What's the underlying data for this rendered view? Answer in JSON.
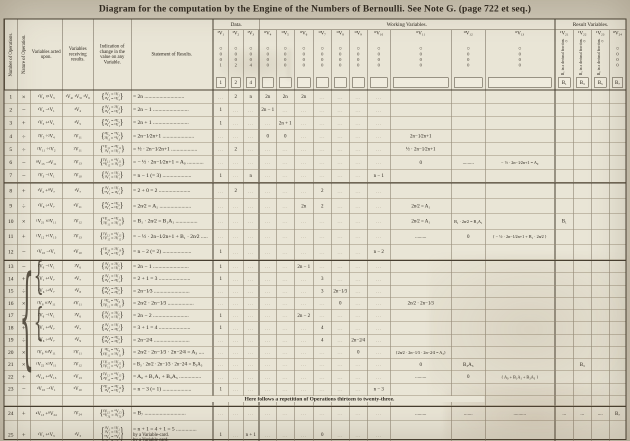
{
  "title": "Diagram for the computation by the Engine of the Numbers of Bernoulli.   See Note G. (page 722 et seq.)",
  "header": {
    "left_columns": [
      "Number of Operations.",
      "Nature of Operation.",
      "Variables acted upon.",
      "Variables receiving results.",
      "Indication of change in the value on any Variable.",
      "Statement of Results."
    ],
    "groups": {
      "data": "Data.",
      "working": "Working Variables.",
      "results": "Result Variables."
    },
    "variables": [
      {
        "id": "v1",
        "label": "¹V₁",
        "dial": [
          "0",
          "0",
          "1"
        ],
        "box": "1"
      },
      {
        "id": "v2",
        "label": "¹V₂",
        "dial": [
          "0",
          "0",
          "2"
        ],
        "box": "2"
      },
      {
        "id": "v3",
        "label": "¹V₃",
        "dial": [
          "0",
          "0",
          "4"
        ],
        "box": "4"
      },
      {
        "id": "v4",
        "label": "⁰V₄",
        "dial": [
          "0",
          "0",
          "0"
        ],
        "box": ""
      },
      {
        "id": "v5",
        "label": "⁰V₅",
        "dial": [
          "0",
          "0",
          "0"
        ],
        "box": ""
      },
      {
        "id": "v6",
        "label": "⁰V₆",
        "dial": [
          "0",
          "0",
          "0"
        ],
        "box": ""
      },
      {
        "id": "v7",
        "label": "⁰V₇",
        "dial": [
          "0",
          "0",
          "0"
        ],
        "box": ""
      },
      {
        "id": "v8",
        "label": "⁰V₈",
        "dial": [
          "0",
          "0",
          "0"
        ],
        "box": ""
      },
      {
        "id": "v9",
        "label": "⁰V₉",
        "dial": [
          "0",
          "0",
          "0"
        ],
        "box": ""
      },
      {
        "id": "v10",
        "label": "⁰V₁₀",
        "dial": [
          "0",
          "0",
          "0"
        ],
        "box": ""
      },
      {
        "id": "v11",
        "label": "⁰V₁₁",
        "dial": [
          "0",
          "0",
          "0"
        ],
        "box": ""
      },
      {
        "id": "v12",
        "label": "⁰V₁₂",
        "dial": [
          "0",
          "0",
          "0"
        ],
        "box": ""
      },
      {
        "id": "v13",
        "label": "⁰V₁₃",
        "dial": [
          "0",
          "0",
          "0"
        ],
        "box": ""
      },
      {
        "id": "v21",
        "label": "¹V₂₁",
        "rot": "B₁ in a decimal fraction.",
        "box": "B₁"
      },
      {
        "id": "v22",
        "label": "¹V₂₂",
        "rot": "B₃ in a decimal fraction.",
        "box": "B₃"
      },
      {
        "id": "v23",
        "label": "¹V₂₃",
        "rot": "B₅ in a decimal fraction.",
        "box": "B₅"
      },
      {
        "id": "v24",
        "label": "⁰V₂₄",
        "dial": [
          "0",
          "0",
          "0"
        ],
        "box": "B₇"
      }
    ]
  },
  "repetition_note": "Here follows a repetition of Operations thirteen to twenty-three.",
  "cell_filler": "...",
  "rows": [
    {
      "num": "1",
      "op": "×",
      "acted": "¹V₂ ×¹V₃",
      "recv": "¹V₄, ¹V₅, ¹V₆",
      "ind": [
        "¹V₂ = ¹V₂",
        "¹V₃ = ¹V₃"
      ],
      "stmt": "= 2n .............................",
      "cells": {
        "v2": "2",
        "v3": "n",
        "v4": "2n",
        "v5": "2n",
        "v6": "2n"
      }
    },
    {
      "num": "2",
      "op": "−",
      "acted": "¹V₄ −¹V₁",
      "recv": "²V₄",
      "ind": [
        "¹V₄ = ²V₄",
        "¹V₁ = ¹V₁"
      ],
      "stmt": "= 2n − 1 ..........................",
      "cells": {
        "v1": "1",
        "v4": "2n − 1"
      }
    },
    {
      "num": "3",
      "op": "+",
      "acted": "¹V₅ +¹V₁",
      "recv": "²V₅",
      "ind": [
        "¹V₅ = ²V₅",
        "¹V₁ = ¹V₁"
      ],
      "stmt": "= 2n + 1 ..........................",
      "cells": {
        "v1": "1",
        "v5": "2n + 1"
      }
    },
    {
      "num": "4",
      "op": "÷",
      "acted": "²V₅ ÷²V₄",
      "recv": "¹V₁₁",
      "ind": [
        "²V₅ = ⁰V₅",
        "²V₄ = ⁰V₄"
      ],
      "stmt": "= 2n−1⁄2n+1 .......................",
      "cells": {
        "v4": "0",
        "v5": "0",
        "v11": "2n−1⁄2n+1"
      }
    },
    {
      "num": "5",
      "op": "÷",
      "acted": "¹V₁₁ ÷¹V₂",
      "recv": "²V₁₁",
      "ind": [
        "¹V₁₁ = ²V₁₁",
        "¹V₂ = ¹V₂"
      ],
      "stmt": "= ½ · 2n−1⁄2n+1 ...................",
      "cells": {
        "v2": "2",
        "v11": "½ · 2n−1⁄2n+1"
      }
    },
    {
      "num": "6",
      "op": "−",
      "acted": "⁰V₁₃ −²V₁₁",
      "recv": "¹V₁₃",
      "ind": [
        "²V₁₁ = ⁰V₁₁",
        "⁰V₁₃ = ¹V₁₃"
      ],
      "stmt": "= − ½ · 2n−1⁄2n+1 = A₀ ............",
      "cells": {
        "v11": "0",
        "v12": ".........",
        "v13": "− ½ · 2n−1⁄2n+1 = A₀"
      }
    },
    {
      "num": "7",
      "op": "−",
      "acted": "¹V₃ −¹V₁",
      "recv": "¹V₁₀",
      "ind": [
        "¹V₃ = ¹V₃",
        "¹V₁ = ¹V₁"
      ],
      "stmt": "= n − 1 (= 3) .....................",
      "cells": {
        "v1": "1",
        "v3": "n",
        "v10": "n − 1"
      }
    },
    {
      "num": "8",
      "op": "+",
      "acted": "¹V₂ +⁰V₇",
      "recv": "¹V₇",
      "ind": [
        "¹V₂ = ¹V₂",
        "⁰V₇ = ¹V₇"
      ],
      "stmt": "= 2 + 0 = 2 .......................",
      "cells": {
        "v2": "2",
        "v7": "2"
      }
    },
    {
      "num": "9",
      "op": "÷",
      "acted": "¹V₆ ÷¹V₇",
      "recv": "³V₁₁",
      "ind": [
        "¹V₆ = ¹V₆",
        "¹V₇ = ¹V₇"
      ],
      "stmt": "= 2n⁄2 = A₁ .......................",
      "cells": {
        "v6": "2n",
        "v7": "2",
        "v11": "2n⁄2 = A₁"
      }
    },
    {
      "num": "10",
      "op": "×",
      "acted": "¹V₂₁ ×³V₁₁",
      "recv": "¹V₁₂",
      "ind": [
        "¹V₂₁ = ¹V₂₁",
        "³V₁₁ = ³V₁₁"
      ],
      "stmt": "= B₁ · 2n⁄2 = B₁A₁ ................",
      "cells": {
        "v11": "2n⁄2 = A₁",
        "v12": "B₁ · 2n⁄2 = B₁A₁",
        "v21": "B₁"
      }
    },
    {
      "num": "11",
      "op": "+",
      "acted": "¹V₁₂ +¹V₁₃",
      "recv": "²V₁₃",
      "ind": [
        "¹V₁₂ = ⁰V₁₂",
        "¹V₁₃ = ²V₁₃"
      ],
      "stmt": "= − ½ · 2n−1⁄2n+1 + B₁ · 2n⁄2 .....",
      "cells": {
        "v11": ".........",
        "v12": "0",
        "v13": "{ − ½ · 2n−1⁄2n+1 + B₁ · 2n⁄2 }"
      }
    },
    {
      "num": "12",
      "op": "−",
      "acted": "¹V₁₀ −¹V₁",
      "recv": "²V₁₀",
      "ind": [
        "¹V₁₀ = ²V₁₀",
        "¹V₁ = ¹V₁"
      ],
      "stmt": "= n − 2 (= 2) .....................",
      "cells": {
        "v1": "1",
        "v10": "n − 2"
      }
    },
    {
      "num": "13",
      "op": "−",
      "acted": "¹V₆ −¹V₁",
      "recv": "²V₆",
      "ind": [
        "¹V₆ = ²V₆",
        "¹V₁ = ¹V₁"
      ],
      "stmt": "= 2n − 1 ..........................",
      "cells": {
        "v1": "1",
        "v6": "2n − 1"
      }
    },
    {
      "num": "14",
      "op": "+",
      "acted": "¹V₁ +¹V₇",
      "recv": "²V₇",
      "ind": [
        "¹V₁ = ¹V₁",
        "¹V₇ = ²V₇"
      ],
      "stmt": "= 2 + 1 = 3 .......................",
      "cells": {
        "v1": "1",
        "v7": "3"
      }
    },
    {
      "num": "15",
      "op": "÷",
      "acted": "²V₆ ÷²V₇",
      "recv": "¹V₈",
      "ind": [
        "²V₆ = ²V₆",
        "²V₇ = ²V₇"
      ],
      "stmt": "= 2n−1⁄3 ..........................",
      "cells": {
        "v7": "3",
        "v8": "2n−1⁄3"
      }
    },
    {
      "num": "16",
      "op": "×",
      "acted": "¹V₈ ×³V₁₁",
      "recv": "⁴V₁₁",
      "ind": [
        "¹V₈ = ⁰V₈",
        "³V₁₁ = ⁴V₁₁"
      ],
      "stmt": "= 2n⁄2 · 2n−1⁄3 ...................",
      "cells": {
        "v8": "0",
        "v11": "2n⁄2 · 2n−1⁄3"
      }
    },
    {
      "num": "17",
      "op": "−",
      "acted": "²V₆ −¹V₁",
      "recv": "³V₆",
      "ind": [
        "²V₆ = ³V₆",
        "¹V₁ = ¹V₁"
      ],
      "stmt": "= 2n − 2 ..........................",
      "cells": {
        "v1": "1",
        "v6": "2n − 2"
      }
    },
    {
      "num": "18",
      "op": "+",
      "acted": "¹V₁ +²V₇",
      "recv": "³V₇",
      "ind": [
        "¹V₁ = ¹V₁",
        "²V₇ = ³V₇"
      ],
      "stmt": "= 3 + 1 = 4 .......................",
      "cells": {
        "v1": "1",
        "v7": "4"
      }
    },
    {
      "num": "19",
      "op": "÷",
      "acted": "³V₆ ÷³V₇",
      "recv": "¹V₉",
      "ind": [
        "³V₆ = ³V₆",
        "³V₇ = ³V₇"
      ],
      "stmt": "= 2n−2⁄4 ..........................",
      "cells": {
        "v7": "4",
        "v9": "2n−2⁄4"
      }
    },
    {
      "num": "20",
      "op": "×",
      "acted": "¹V₉ ×⁴V₁₁",
      "recv": "⁵V₁₁",
      "ind": [
        "¹V₉ = ⁰V₉",
        "⁴V₁₁ = ⁵V₁₁"
      ],
      "stmt": "= 2n⁄2 · 2n−1⁄3 · 2n−2⁄4 = A₃ ....",
      "cells": {
        "v9": "0",
        "v11": "{2n⁄2 · 2n−1⁄3 · 2n−2⁄4 = A₃}"
      }
    },
    {
      "num": "21",
      "op": "×",
      "acted": "¹V₂₂ ×⁵V₁₁",
      "recv": "²V₁₂",
      "ind": [
        "¹V₂₂ = ¹V₂₂",
        "⁵V₁₁ = ⁰V₁₁"
      ],
      "stmt": "= B₃ · 2n⁄2 · 2n−1⁄3 · 2n−2⁄4 = B₃A₃",
      "cells": {
        "v11": "0",
        "v12": "B₃A₃",
        "v22": "B₃"
      }
    },
    {
      "num": "22",
      "op": "+",
      "acted": "²V₁₂ +²V₁₃",
      "recv": "³V₁₃",
      "ind": [
        "²V₁₂ = ⁰V₁₂",
        "²V₁₃ = ³V₁₃"
      ],
      "stmt": "= A₀ + B₁A₁ + B₃A₃ ................",
      "cells": {
        "v11": ".........",
        "v12": "0",
        "v13": "{ A₀ + B₁A₁ + B₃A₃ }"
      }
    },
    {
      "num": "23",
      "op": "−",
      "acted": "²V₁₀ −¹V₁",
      "recv": "³V₁₀",
      "ind": [
        "²V₁₀ = ³V₁₀",
        "¹V₁ = ¹V₁"
      ],
      "stmt": "= n − 3 (= 1) .....................",
      "cells": {
        "v1": "1",
        "v10": "n − 3"
      }
    },
    {
      "num": "24",
      "op": "+",
      "acted": "⁴V₁₃ +⁰V₂₄",
      "recv": "¹V₂₄",
      "ind": [
        "⁴V₁₃ = ⁰V₁₃",
        "⁰V₂₄ = ¹V₂₄"
      ],
      "stmt": "= B₇ ..............................",
      "cells": {
        "v11": ".........",
        "v12": ".......",
        "v13": "..........",
        "v21": "...",
        "v22": "...",
        "v23": "....",
        "v24": "B₇"
      }
    },
    {
      "num": "25",
      "op": "+",
      "acted": "¹V₁ +¹V₃",
      "recv": "¹V₃",
      "ind": [
        "¹V₁ = ¹V₁",
        "¹V₃ = ¹V₃",
        "⁰V₆ = ⁰V₆",
        "⁰V₇ = ⁰V₇"
      ],
      "stmt": "= n + 1 = 4 + 1 = 5 ...............",
      "stmt_extra": [
        "by a Variable-card.",
        "by a Variable card."
      ],
      "cells": {
        "v1": "1",
        "v3": "n + 1",
        "v7": "0"
      }
    }
  ]
}
